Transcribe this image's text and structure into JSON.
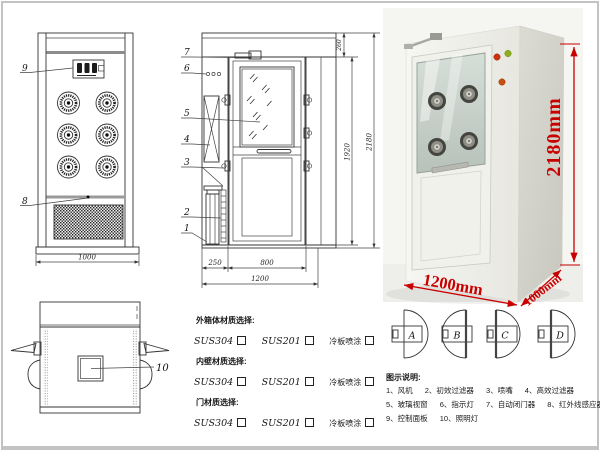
{
  "front_view": {
    "callout_control_panel": "9",
    "callout_ir_sensor": "8",
    "dim_width": "1000"
  },
  "side_view": {
    "callout_door_closer": "7",
    "callout_indicator_light": "6",
    "callout_glass_window": "5",
    "callout_hepa_filter": "4",
    "callout_nozzle": "3",
    "callout_primary_filter": "2",
    "callout_fan": "1",
    "dim_left_cabinet": "250",
    "dim_door_width": "800",
    "dim_total_width": "1200",
    "dim_door_height": "1920",
    "dim_total_height": "2180",
    "dim_top_section": "260"
  },
  "top_view": {
    "callout_lamp": "10"
  },
  "photo": {
    "dim_height": "2180mm",
    "dim_width": "1200mm",
    "dim_depth": "1000mm"
  },
  "materials": {
    "sections": [
      {
        "title": "外箱体材质选择:",
        "options": [
          "SUS304",
          "SUS201",
          "冷板喷涂"
        ]
      },
      {
        "title": "内壁材质选择:",
        "options": [
          "SUS304",
          "SUS201",
          "冷板喷涂"
        ]
      },
      {
        "title": "门材质选择:",
        "options": [
          "SUS304",
          "SUS201",
          "冷板喷涂"
        ]
      }
    ]
  },
  "door_styles": {
    "labels": [
      "A",
      "B",
      "C",
      "D"
    ]
  },
  "legend": {
    "title": "图示说明:",
    "rows": [
      [
        "1、风机",
        "2、初效过滤器",
        "3、喷嘴",
        "4、高效过滤器"
      ],
      [
        "5、玻璃视窗",
        "6、指示灯",
        "7、自动闭门器",
        "8、红外线感应器"
      ],
      [
        "9、控制面板",
        "10、照明灯"
      ]
    ]
  },
  "colors": {
    "dimension_red": "#c80000",
    "drawing_line": "#333333"
  }
}
